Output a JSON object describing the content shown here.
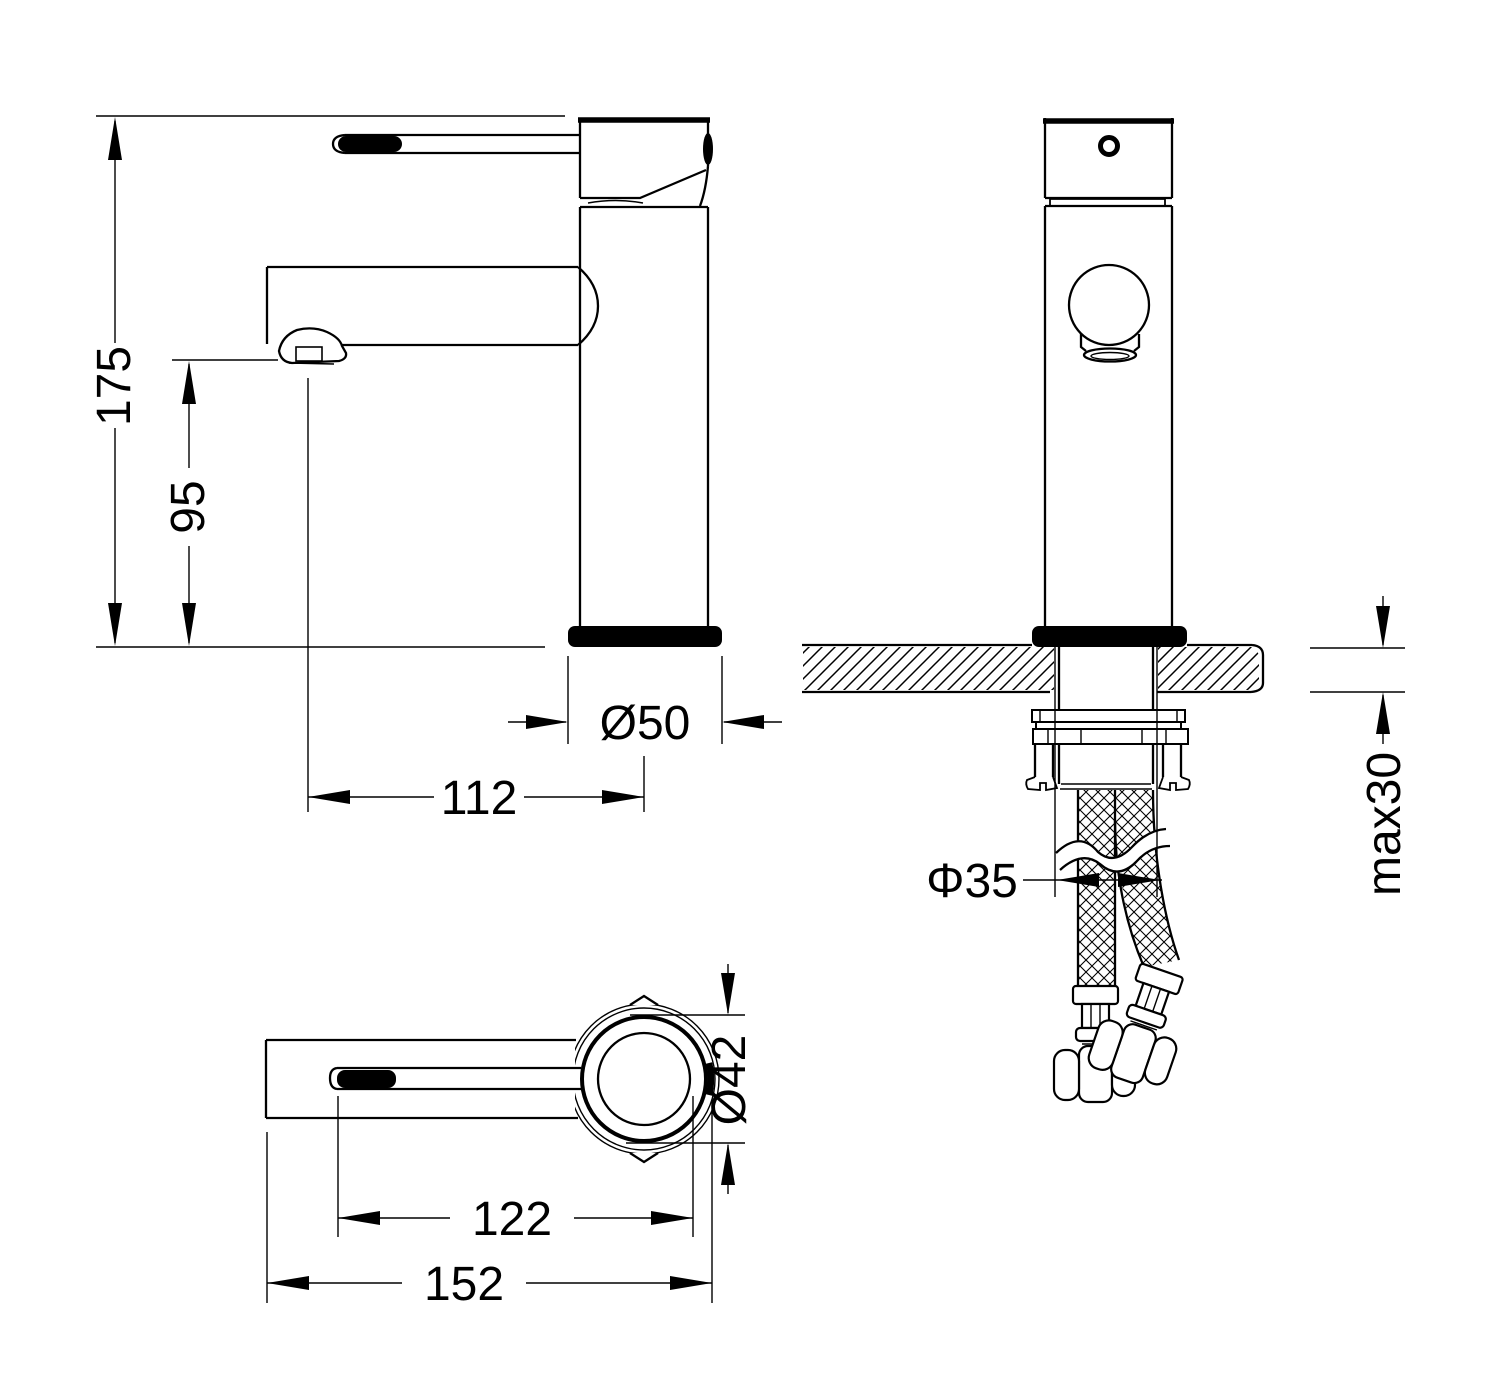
{
  "drawing": {
    "description": "Basin mixer faucet installation drawing with three orthographic views",
    "colors": {
      "line": "#000000",
      "background": "#ffffff"
    },
    "dimensions": {
      "total_height": "175",
      "spout_height": "95",
      "base_diameter": "Ø50",
      "spout_reach": "112",
      "mount_hole_diameter": "Φ35",
      "max_counter_thickness": "max30",
      "body_diameter": "Ø42",
      "handle_length": "122",
      "overall_length": "152"
    }
  }
}
